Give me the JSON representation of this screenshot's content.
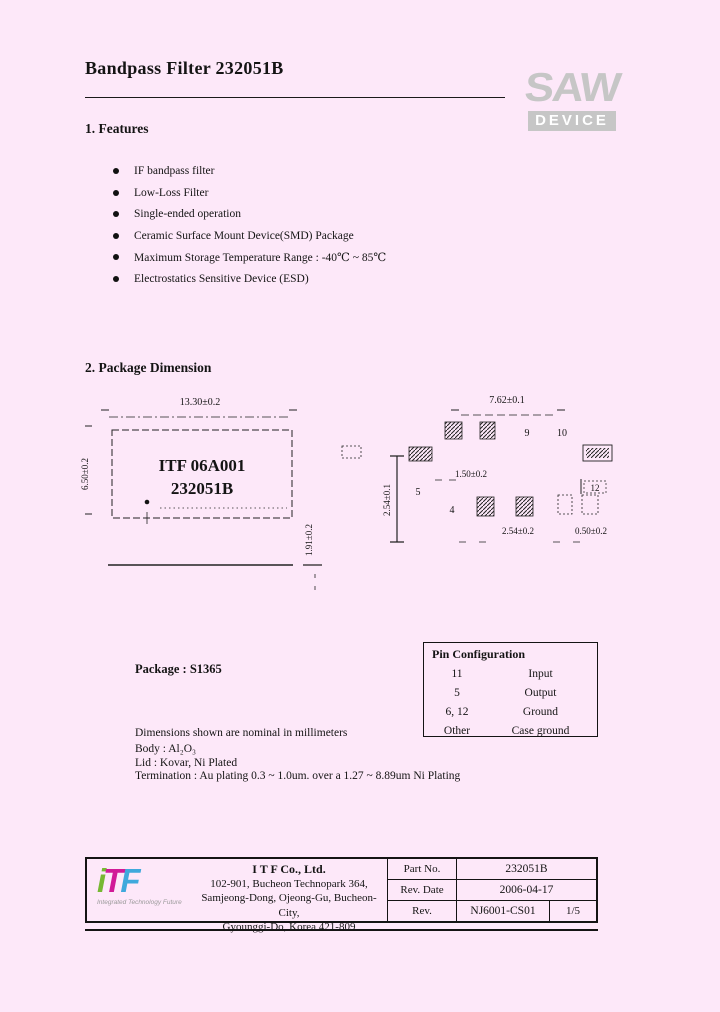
{
  "page": {
    "title": "Bandpass Filter 232051B"
  },
  "brand": {
    "saw": "SAW",
    "device": "DEVICE"
  },
  "colors": {
    "page_background": "#fde8f9",
    "saw_logo_gray": "#c6c6c6",
    "itf_green": "#76b832",
    "itf_magenta": "#d11a97",
    "itf_blue": "#3fa9dc"
  },
  "sections": {
    "features_heading": "1. Features",
    "package_heading": "2. Package Dimension"
  },
  "features": [
    "IF bandpass filter",
    "Low-Loss Filter",
    "Single-ended operation",
    "Ceramic Surface Mount Device(SMD) Package",
    "Maximum Storage Temperature Range : -40℃ ~ 85℃",
    "Electrostatics Sensitive Device (ESD)"
  ],
  "drawing": {
    "chip_line1": "ITF 06A001",
    "chip_line2": "232051B",
    "body_width": "13.30±0.2",
    "body_height": "6.50±0.2",
    "side_height": "1.91±0.2",
    "land_width": "7.62±0.1",
    "land_height": "2.54±0.1",
    "pad_pitch_small": "1.50±0.2",
    "pad_pitch": "2.54±0.2",
    "pad_width": "0.50±0.2",
    "top_pins": [
      "9",
      "10"
    ],
    "bottom_pins": [
      "5",
      "4"
    ],
    "right_pins": [
      "12"
    ]
  },
  "package_label": "Package : S1365",
  "pin_config": {
    "title": "Pin Configuration",
    "rows": [
      {
        "pin": "11",
        "func": "Input"
      },
      {
        "pin": "5",
        "func": "Output"
      },
      {
        "pin": "6, 12",
        "func": "Ground"
      },
      {
        "pin": "Other",
        "func": "Case ground"
      }
    ]
  },
  "notes": [
    "Dimensions shown are nominal in millimeters",
    "Body : Al₂O₃",
    "Lid : Kovar, Ni Plated",
    "Termination : Au plating 0.3 ~ 1.0um. over a 1.27 ~ 8.89um Ni Plating"
  ],
  "footer": {
    "logo": {
      "i": "i",
      "t": "T",
      "f": "F",
      "tagline": "Integrated Technology Future"
    },
    "company": "I T F   Co., Ltd.",
    "address1": "102-901, Bucheon Technopark 364,",
    "address2": "Samjeong-Dong, Ojeong-Gu, Bucheon-City,",
    "address3": "Gyounggi-Do, Korea 421-809",
    "part_no_label": "Part No.",
    "part_no": "232051B",
    "rev_date_label": "Rev. Date",
    "rev_date": "2006-04-17",
    "rev_label": "Rev.",
    "rev": "NJ6001-CS01",
    "page_no": "1/5"
  }
}
